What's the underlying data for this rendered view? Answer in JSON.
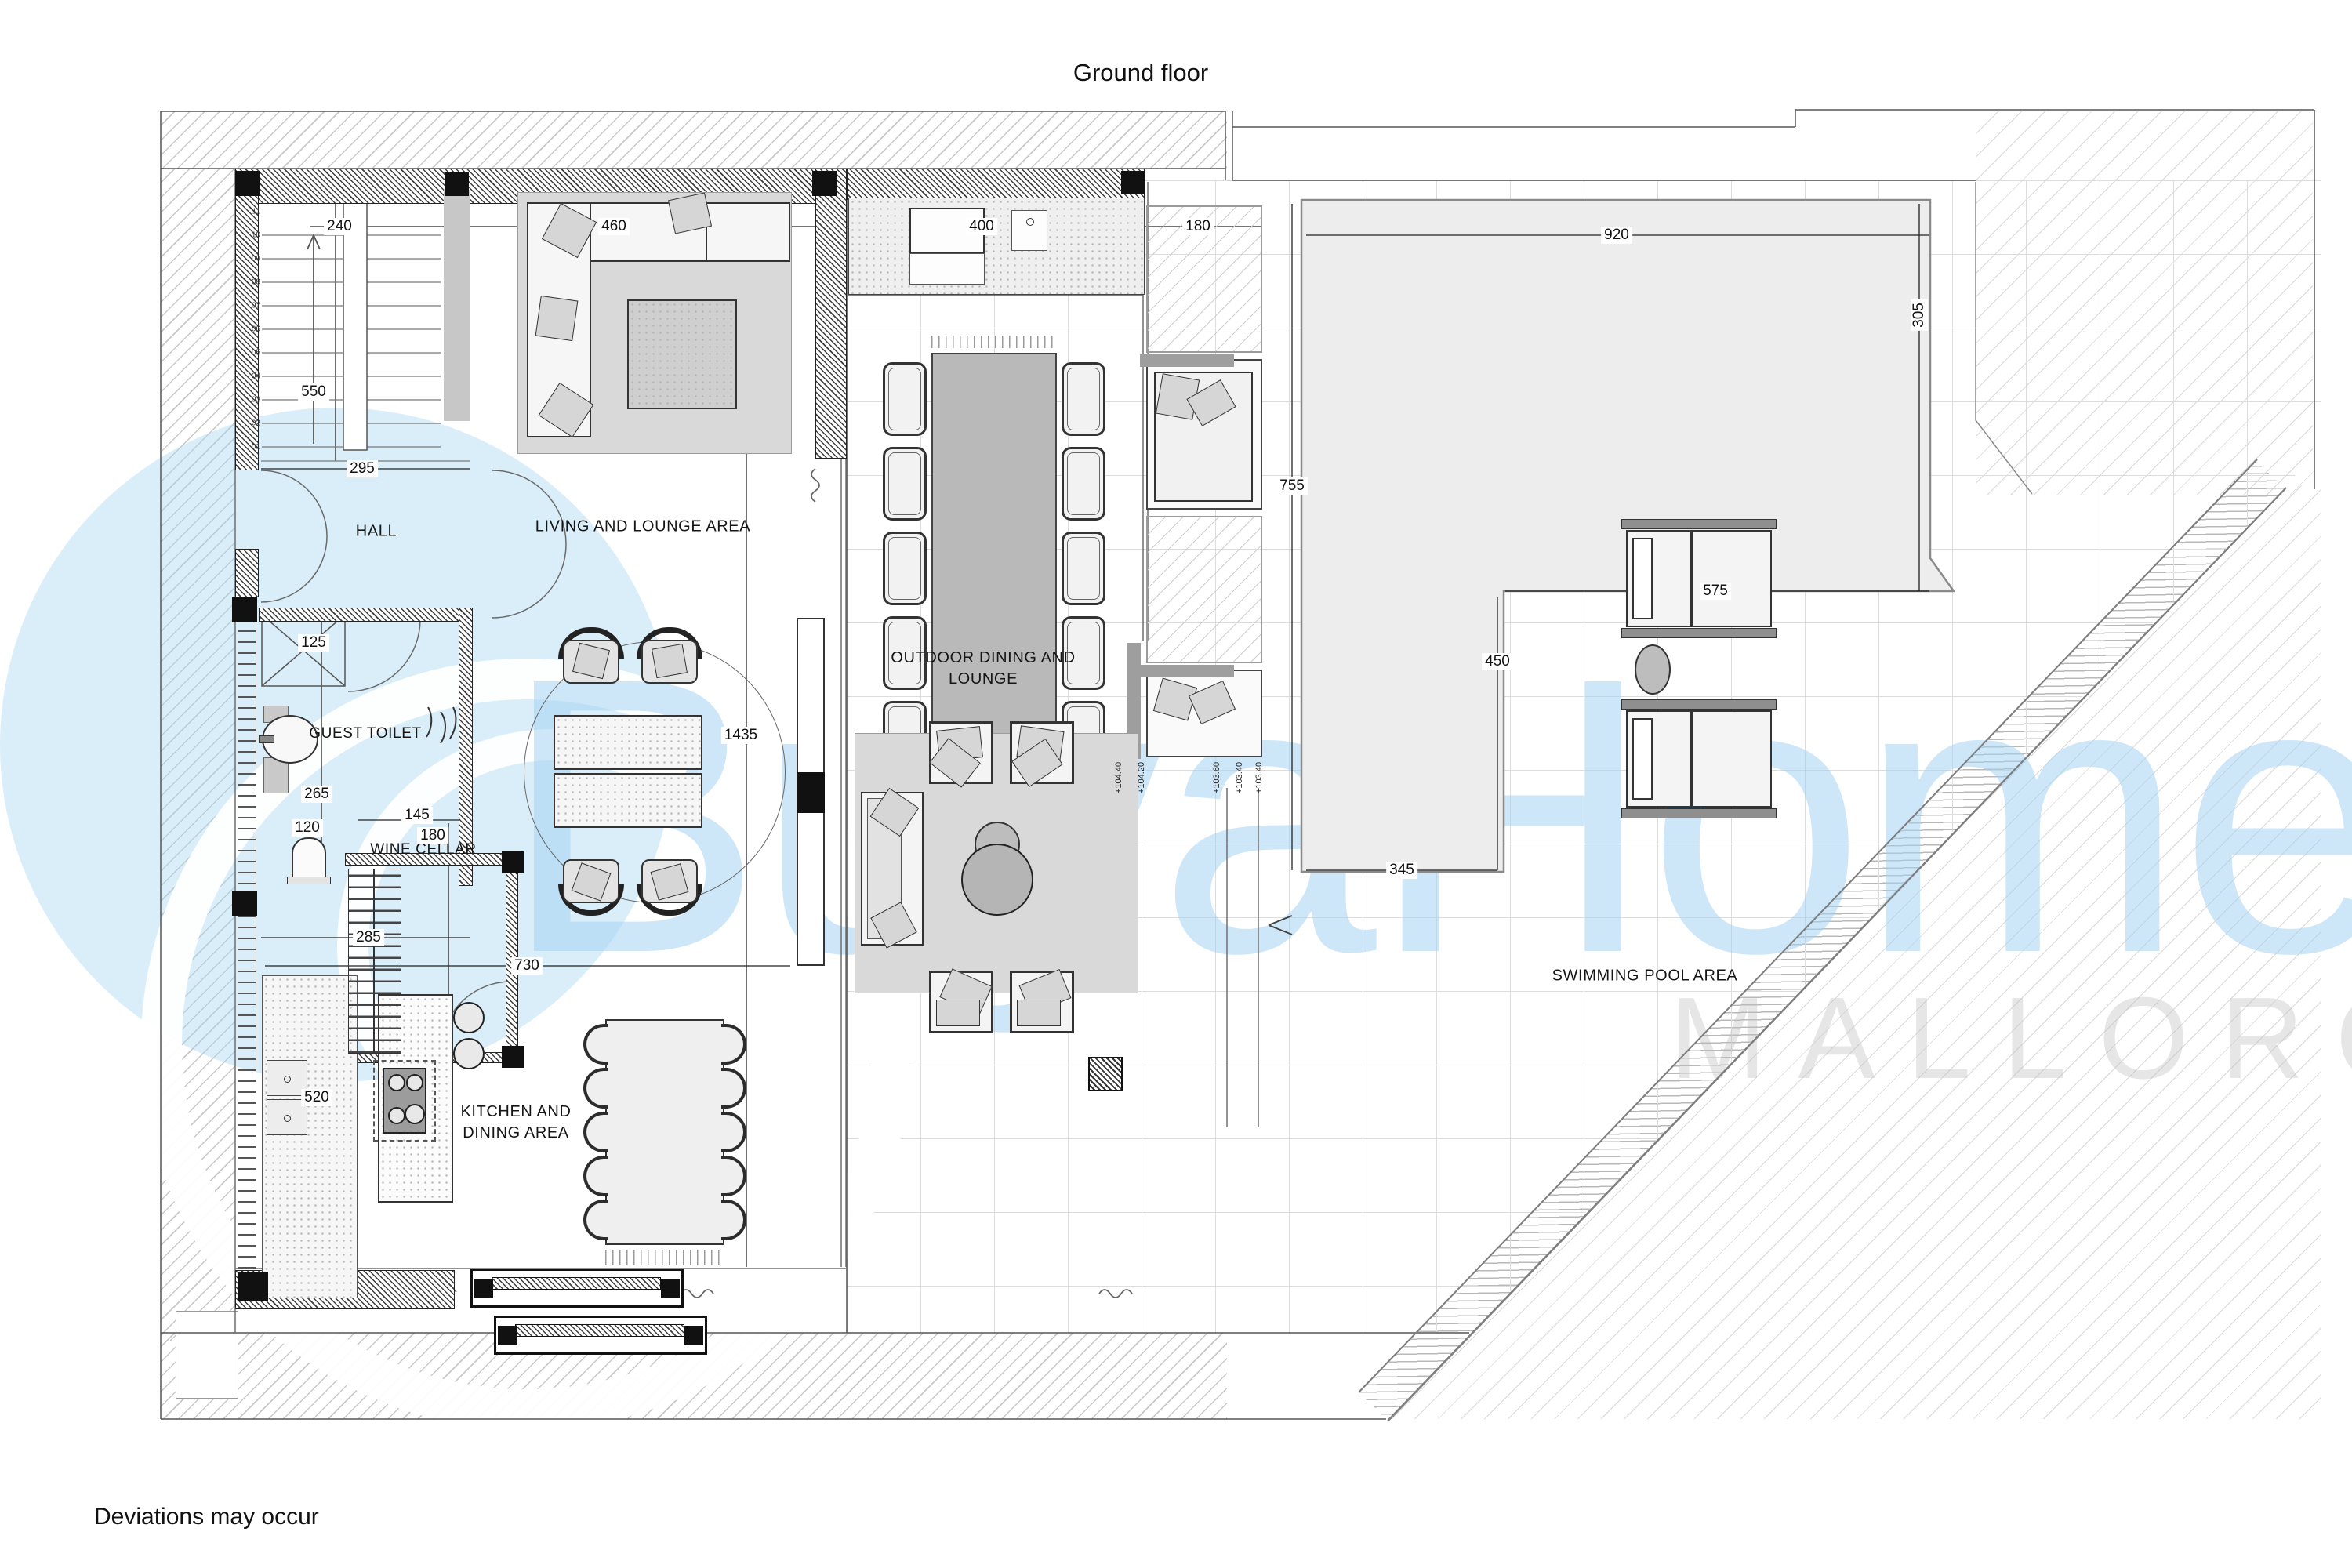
{
  "title": "Ground floor",
  "footer": "Deviations may occur",
  "watermark": {
    "brand": "BuyaHome",
    "region": "MALLORCA"
  },
  "rooms": {
    "hall": "HALL",
    "living": "LIVING AND LOUNGE AREA",
    "guest_toilet": "GUEST TOILET",
    "wine_cellar": "WINE CELLAR",
    "kitchen": "KITCHEN AND\nDINING AREA",
    "outdoor": "OUTDOOR DINING AND\nLOUNGE",
    "pool": "SWIMMING POOL AREA"
  },
  "dimensions": {
    "stair_width": "240",
    "stair_depth": "550",
    "hall_width": "295",
    "sofa_width": "460",
    "entry_closet": "125",
    "toilet_depth": "265",
    "toilet_width": "120",
    "cellar_width": "145",
    "cellar_depth": "180",
    "bottom_width": "285",
    "kitchen_depth": "520",
    "kitchen_width": "730",
    "living_length": "1435",
    "terrace_width": "400",
    "planter_width": "180",
    "pool_top": "920",
    "pool_right": "305",
    "pool_inner": "575",
    "pool_left": "755",
    "pool_inner_right": "450",
    "pool_bottom": "345"
  },
  "stairs": {
    "steps": [
      "01",
      "02",
      "03",
      "04",
      "05",
      "06",
      "07",
      "08",
      "09",
      "10",
      "11"
    ]
  },
  "elevations": [
    "+104.40",
    "+104.20",
    "+103.60",
    "+103.40",
    "+103.40"
  ],
  "colors": {
    "watermark_blue": "#cfe8f8",
    "watermark_gray": "#ececec",
    "pool_fill": "#ededed",
    "line": "#444444"
  }
}
